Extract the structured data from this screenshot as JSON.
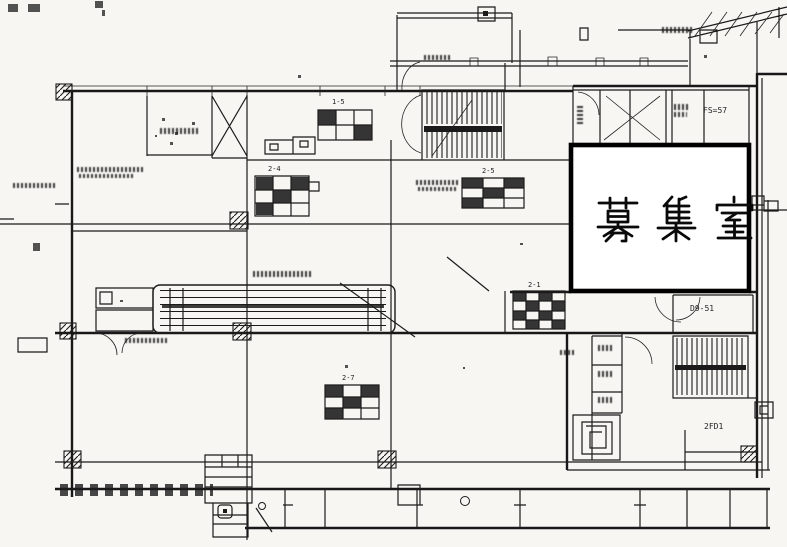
{
  "drawing": {
    "main_room_label": "募集室",
    "labels": {
      "fs57": "FS=57",
      "d951": "D9-51",
      "fd1": "2FD1",
      "sched_15": "1-5",
      "sched_24": "2-4",
      "sched_25": "2-5",
      "sched_21": "2-1",
      "sched_27": "2-7"
    },
    "colors": {
      "paper": "#f7f6f2",
      "ink": "#1b1b1b",
      "highlight_border": "#000000",
      "room_fill": "#ffffff"
    }
  }
}
